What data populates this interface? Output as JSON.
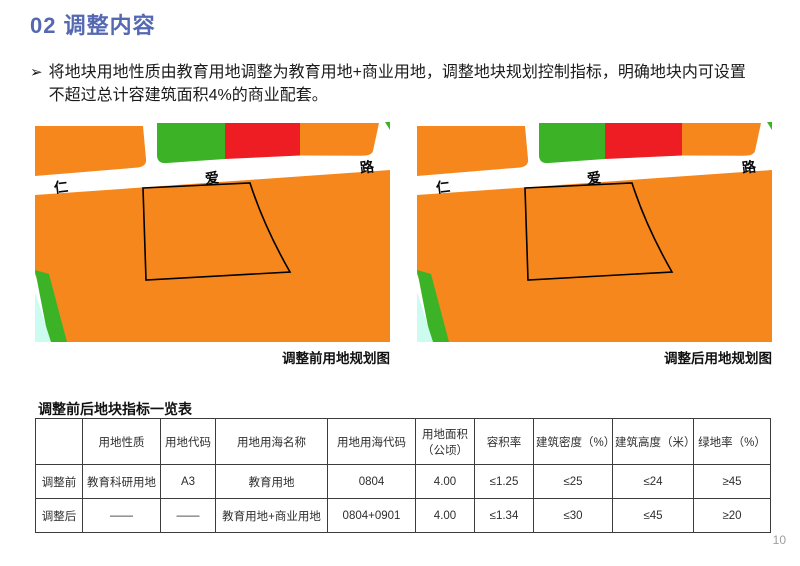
{
  "header": {
    "title": "02 调整内容"
  },
  "bullet": {
    "marker": "➢",
    "text": "将地块用地性质由教育用地调整为教育用地+商业用地，调整地块规划控制指标，明确地块内可设置不超过总计容建筑面积4%的商业配套。"
  },
  "maps": {
    "road_labels": [
      "仁",
      "爱",
      "路"
    ],
    "before_caption": "调整前用地规划图",
    "after_caption": "调整后用地规划图",
    "colors": {
      "land_orange": "#F6871D",
      "land_green": "#3CB327",
      "land_red": "#EE1C23",
      "land_cyan": "#CCFBF0",
      "road_white": "#FFFFFF",
      "parcel_outline": "#000000"
    }
  },
  "table": {
    "title": "调整前后地块指标一览表",
    "headers": [
      "",
      "用地性质",
      "用地代码",
      "用地用海名称",
      "用地用海代码",
      "用地面积（公顷）",
      "容积率",
      "建筑密度（%）",
      "建筑高度（米）",
      "绿地率（%）"
    ],
    "rows": [
      {
        "label": "调整前",
        "cells": [
          "教育科研用地",
          "A3",
          "教育用地",
          "0804",
          "4.00",
          "≤1.25",
          "≤25",
          "≤24",
          "≥45"
        ]
      },
      {
        "label": "调整后",
        "cells": [
          "——",
          "——",
          "教育用地+商业用地",
          "0804+0901",
          "4.00",
          "≤1.34",
          "≤30",
          "≤45",
          "≥20"
        ]
      }
    ]
  },
  "footer": {
    "page_number": "10"
  }
}
